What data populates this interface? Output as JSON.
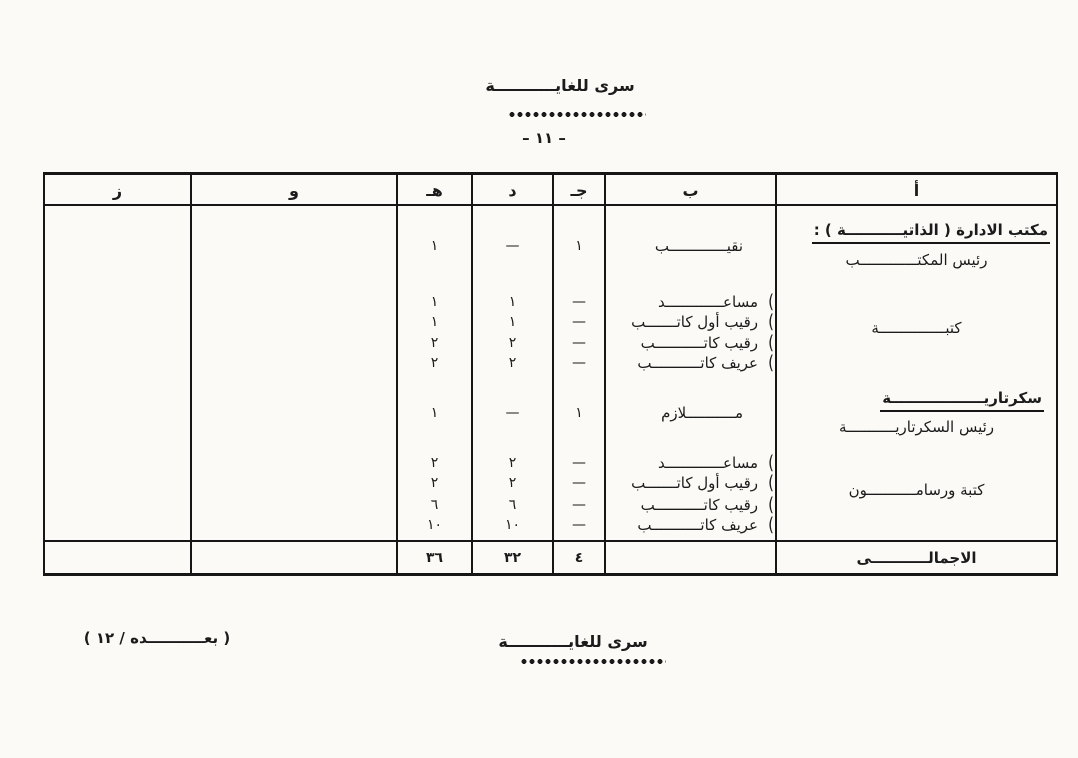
{
  "page": {
    "classification_top": "سرى للغايـــــــــــة",
    "page_number": "– ١١ –",
    "classification_bottom": "سرى للغايـــــــــــة",
    "continuation_note": "( بعـــــــــــده / ١٢ )"
  },
  "colors": {
    "ink": "#1b1b1b",
    "paper": "#fbfaf7"
  },
  "table": {
    "column_headers": [
      "أ",
      "ب",
      "جـ",
      "د",
      "هـ",
      "و",
      "ز"
    ],
    "sections": [
      {
        "heading": "مكتب الادارة  ( الذاتيـــــــــــة ) :",
        "subheading": "رئيس المكتـــــــــــــب",
        "group_label": "كتبـــــــــــــــة",
        "rows": [
          {
            "rank": "نقيـــــــــــــب",
            "brace": "",
            "j": "١",
            "d": "—",
            "h": "١"
          },
          {
            "rank": "مساعـــــــــــــد",
            "brace": "(",
            "j": "—",
            "d": "١",
            "h": "١"
          },
          {
            "rank": "رقيب أول كاتـــــــب",
            "brace": "(",
            "j": "—",
            "d": "١",
            "h": "١"
          },
          {
            "rank": "رقيب كاتـــــــــــب",
            "brace": "(",
            "j": "—",
            "d": "٢",
            "h": "٢"
          },
          {
            "rank": "عريف كاتـــــــــــب",
            "brace": "(",
            "j": "—",
            "d": "٢",
            "h": "٢"
          }
        ]
      },
      {
        "heading": "سكرتاريــــــــــــــــــة",
        "subheading": "رئيس السكرتاريـــــــــــة",
        "group_label": "كتبة ورسامـــــــــــون",
        "rows": [
          {
            "rank": "مـــــــــــلازم",
            "brace": "",
            "j": "١",
            "d": "—",
            "h": "١"
          },
          {
            "rank": "مساعـــــــــــــد",
            "brace": "(",
            "j": "—",
            "d": "٢",
            "h": "٢"
          },
          {
            "rank": "رقيب أول كاتـــــــب",
            "brace": "(",
            "j": "—",
            "d": "٢",
            "h": "٢"
          },
          {
            "rank": "رقيب كاتـــــــــــب",
            "brace": "(",
            "j": "—",
            "d": "٦",
            "h": "٦"
          },
          {
            "rank": "عريف كاتـــــــــــب",
            "brace": "(",
            "j": "—",
            "d": "١٠",
            "h": "١٠"
          }
        ]
      }
    ],
    "total": {
      "label": "الاجمالـــــــــــى",
      "j": "٤",
      "d": "٣٢",
      "h": "٣٦"
    }
  }
}
